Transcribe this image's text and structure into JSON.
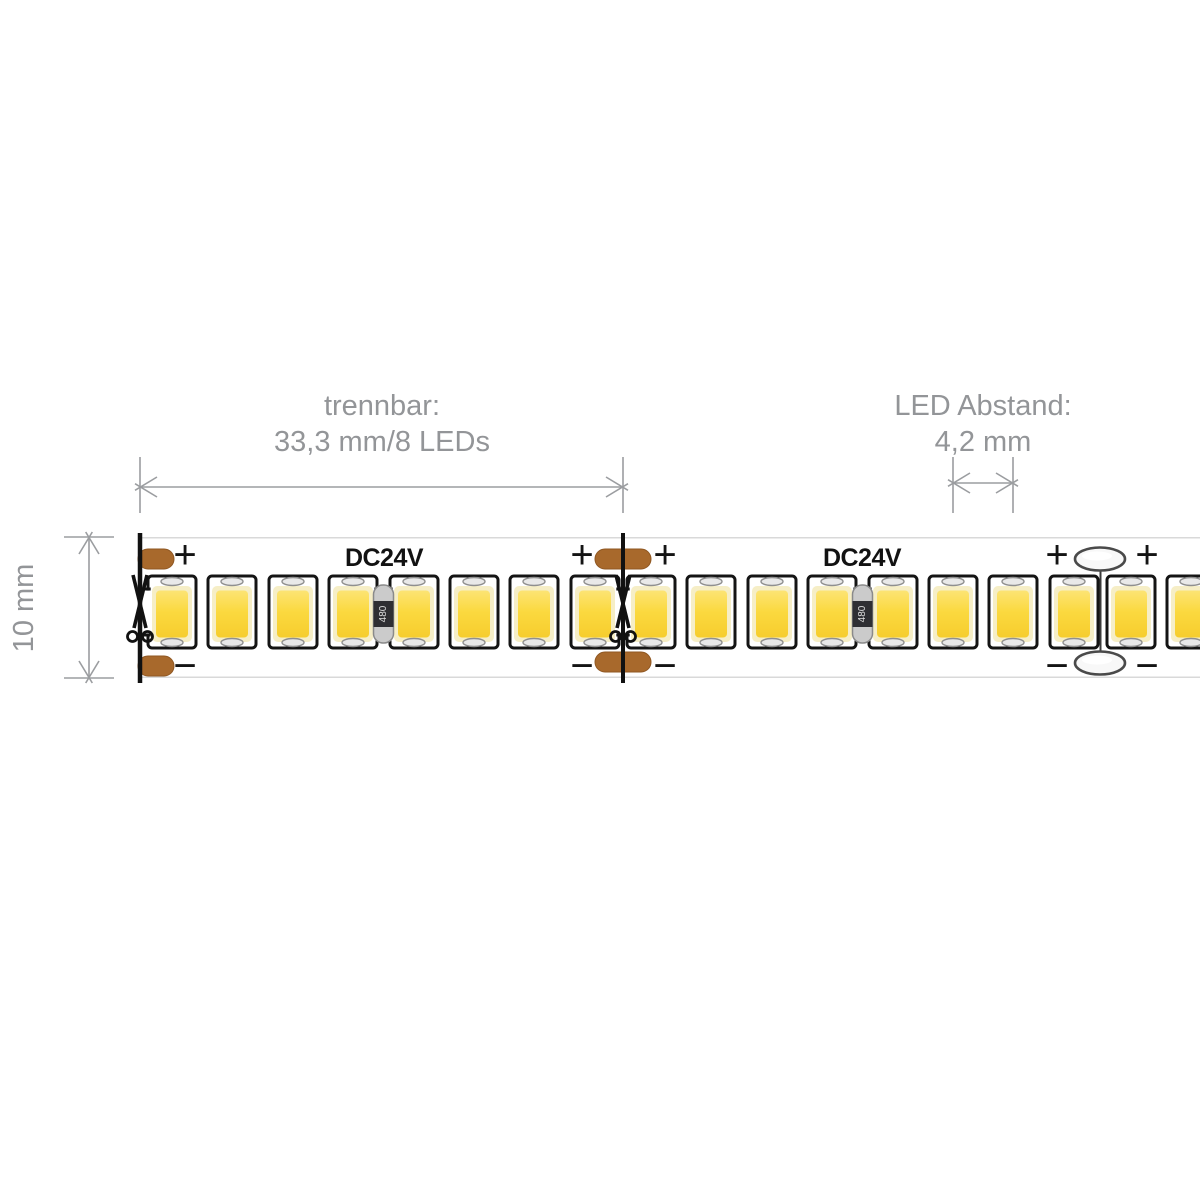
{
  "title": "LED strip dimension diagram",
  "colors": {
    "background": "#ffffff",
    "dimension_line": "#9b9da0",
    "label_text": "#939598",
    "outline": "#141414",
    "pcb": "#ffffff",
    "pcb_edge": "#d9d9d9",
    "pad_copper": "#a8692c",
    "pad_copper_edge": "#8f5722",
    "led_yellow": "#fbd93f",
    "led_yellow_light": "#fce474",
    "led_yellow_deep": "#f6cd2e",
    "led_pale_ring": "#f6eec6",
    "electrode_fill": "#e9e9e9",
    "electrode_stroke": "#8f8f8f",
    "solder_fill": "#f8f8f8",
    "solder_stroke": "#4a4a4a",
    "resistor_cap": "#cbcbcb",
    "resistor_cap_edge": "#8a8a8a",
    "resistor_body": "#2f2f33",
    "resistor_text_color": "#dedede",
    "cut_line": "#111111"
  },
  "annotations": {
    "separable": {
      "line1": "trennbar:",
      "line2": "33,3 mm/8 LEDs",
      "x_start": 140,
      "x_end": 623,
      "arrow_y": 487,
      "ext_top": 457,
      "ext_bottom": 513,
      "text_x": 382,
      "text_y1": 415,
      "text_y2": 451
    },
    "led_spacing": {
      "line1": "LED Abstand:",
      "line2": "4,2 mm",
      "x_start": 953,
      "x_end": 1013,
      "arrow_y": 483,
      "ext_top": 457,
      "ext_bottom": 513,
      "text_x": 983,
      "text_y1": 415,
      "text_y2": 451
    },
    "strip_width": {
      "label": "10 mm",
      "y_start": 537,
      "y_end": 678,
      "arrow_x": 89,
      "cap_x1": 64,
      "cap_x2": 114,
      "text_x": 33,
      "text_y": 608
    }
  },
  "strip": {
    "left": 140,
    "right": 1200,
    "top": 537,
    "bottom": 678,
    "voltage_label": "DC24V",
    "voltage_label_positions": [
      384,
      862
    ],
    "voltage_label_y": 566,
    "resistor_label": "480",
    "resistors": [
      383.5,
      862.5
    ],
    "led_centers": [
      172,
      232,
      293,
      353,
      414,
      474,
      534,
      595,
      651,
      711,
      772,
      832,
      893,
      953,
      1013,
      1074,
      1131,
      1191
    ],
    "bridges_resistor": [
      [
        353,
        414
      ],
      [
        832,
        893
      ]
    ],
    "bridges_cut": [
      [
        595,
        651
      ]
    ],
    "bridge_stub_end": 172,
    "cut_lines": [
      140,
      623
    ],
    "solder_joints": [
      1100
    ],
    "plus_label": "+",
    "minus_label": "−",
    "polarity_x": [
      185,
      582,
      665,
      1057,
      1147
    ],
    "plus_y": 555,
    "minus_y": 666
  }
}
